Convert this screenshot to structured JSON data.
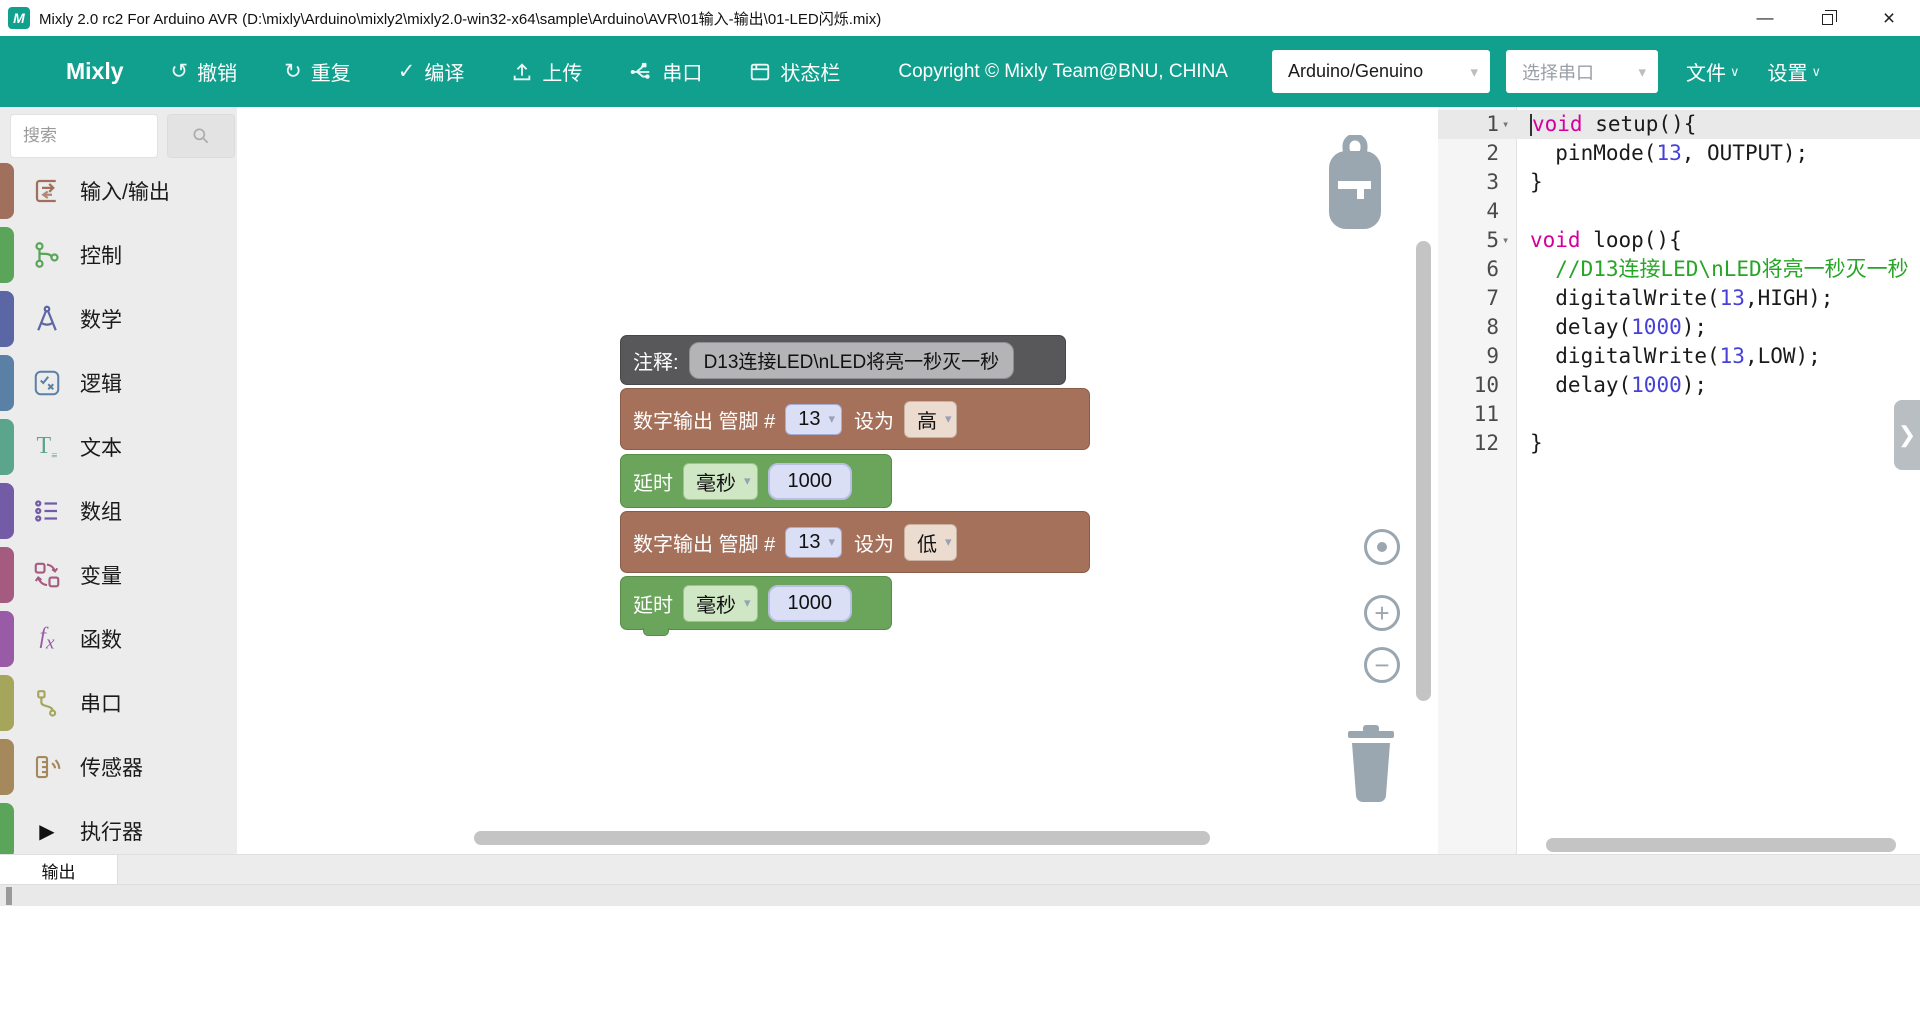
{
  "window": {
    "title": "Mixly 2.0 rc2 For Arduino AVR (D:\\mixly\\Arduino\\mixly2\\mixly2.0-win32-x64\\sample\\Arduino\\AVR\\01输入-输出\\01-LED闪烁.mix)",
    "logo_letter": "M",
    "minimize_glyph": "—",
    "close_glyph": "×"
  },
  "toolbar": {
    "brand": "Mixly",
    "buttons": [
      {
        "name": "undo",
        "label": "撤销",
        "glyph": "↺"
      },
      {
        "name": "redo",
        "label": "重复",
        "glyph": "↻"
      },
      {
        "name": "compile",
        "label": "编译",
        "glyph": "✓"
      },
      {
        "name": "upload",
        "label": "上传",
        "glyph": ""
      },
      {
        "name": "serial",
        "label": "串口",
        "glyph": ""
      },
      {
        "name": "statusbar",
        "label": "状态栏",
        "glyph": ""
      }
    ],
    "copyright": "Copyright © Mixly Team@BNU, CHINA",
    "board_select": "Arduino/Genuino",
    "port_select": "选择串口",
    "file_menu": "文件",
    "settings_menu": "设置",
    "caret_glyph": "▾",
    "menu_caret_glyph": "∨"
  },
  "sidebar": {
    "search_placeholder": "搜索",
    "categories": [
      {
        "label": "输入/输出",
        "color": "#A0705C",
        "icon": "io-icon"
      },
      {
        "label": "控制",
        "color": "#5BA55B",
        "icon": "control-branch-icon"
      },
      {
        "label": "数学",
        "color": "#5B67A5",
        "icon": "math-compass-icon"
      },
      {
        "label": "逻辑",
        "color": "#5B80A5",
        "icon": "logic-check-icon"
      },
      {
        "label": "文本",
        "color": "#5BA58C",
        "icon": "text-icon"
      },
      {
        "label": "数组",
        "color": "#745BA5",
        "icon": "array-list-icon"
      },
      {
        "label": "变量",
        "color": "#A55B80",
        "icon": "variable-swap-icon"
      },
      {
        "label": "函数",
        "color": "#995BA5",
        "icon": "function-fx-icon"
      },
      {
        "label": "串口",
        "color": "#A5A55B",
        "icon": "serial-cable-icon"
      },
      {
        "label": "传感器",
        "color": "#A5885B",
        "icon": "sensor-icon"
      },
      {
        "label": "执行器",
        "color": "#5BA55B",
        "icon": "actuator-play-icon"
      }
    ]
  },
  "canvas": {
    "blocks": {
      "comment": {
        "label": "注释:",
        "text": "D13连接LED\\nLED将亮一秒灭一秒"
      },
      "digital_write_1": {
        "prefix": "数字输出 管脚 #",
        "pin": "13",
        "set_label": "设为",
        "value": "高"
      },
      "delay_1": {
        "label": "延时",
        "unit": "毫秒",
        "value": "1000"
      },
      "digital_write_2": {
        "prefix": "数字输出 管脚 #",
        "pin": "13",
        "set_label": "设为",
        "value": "低"
      },
      "delay_2": {
        "label": "延时",
        "unit": "毫秒",
        "value": "1000"
      }
    }
  },
  "code": {
    "lines": [
      {
        "n": "1",
        "fold": true,
        "active": true,
        "cursor": true,
        "tokens": [
          {
            "t": "void",
            "c": "kw"
          },
          {
            "t": " setup(){",
            "c": "pl"
          }
        ]
      },
      {
        "n": "2",
        "tokens": [
          {
            "t": "  pinMode(",
            "c": "pl"
          },
          {
            "t": "13",
            "c": "num"
          },
          {
            "t": ", OUTPUT);",
            "c": "pl"
          }
        ]
      },
      {
        "n": "3",
        "tokens": [
          {
            "t": "}",
            "c": "pl"
          }
        ]
      },
      {
        "n": "4",
        "tokens": []
      },
      {
        "n": "5",
        "fold": true,
        "tokens": [
          {
            "t": "void",
            "c": "kw"
          },
          {
            "t": " loop(){",
            "c": "pl"
          }
        ]
      },
      {
        "n": "6",
        "tokens": [
          {
            "t": "  //D13连接LED\\nLED将亮一秒灭一秒",
            "c": "com"
          }
        ]
      },
      {
        "n": "7",
        "tokens": [
          {
            "t": "  digitalWrite(",
            "c": "pl"
          },
          {
            "t": "13",
            "c": "num"
          },
          {
            "t": ",HIGH);",
            "c": "pl"
          }
        ]
      },
      {
        "n": "8",
        "tokens": [
          {
            "t": "  delay(",
            "c": "pl"
          },
          {
            "t": "1000",
            "c": "num"
          },
          {
            "t": ");",
            "c": "pl"
          }
        ]
      },
      {
        "n": "9",
        "tokens": [
          {
            "t": "  digitalWrite(",
            "c": "pl"
          },
          {
            "t": "13",
            "c": "num"
          },
          {
            "t": ",LOW);",
            "c": "pl"
          }
        ]
      },
      {
        "n": "10",
        "tokens": [
          {
            "t": "  delay(",
            "c": "pl"
          },
          {
            "t": "1000",
            "c": "num"
          },
          {
            "t": ");",
            "c": "pl"
          }
        ]
      },
      {
        "n": "11",
        "tokens": []
      },
      {
        "n": "12",
        "tokens": [
          {
            "t": "}",
            "c": "pl"
          }
        ]
      }
    ],
    "expand_chevron": "❯",
    "fold_glyph": "▾"
  },
  "output_panel": {
    "tab": "输出"
  }
}
